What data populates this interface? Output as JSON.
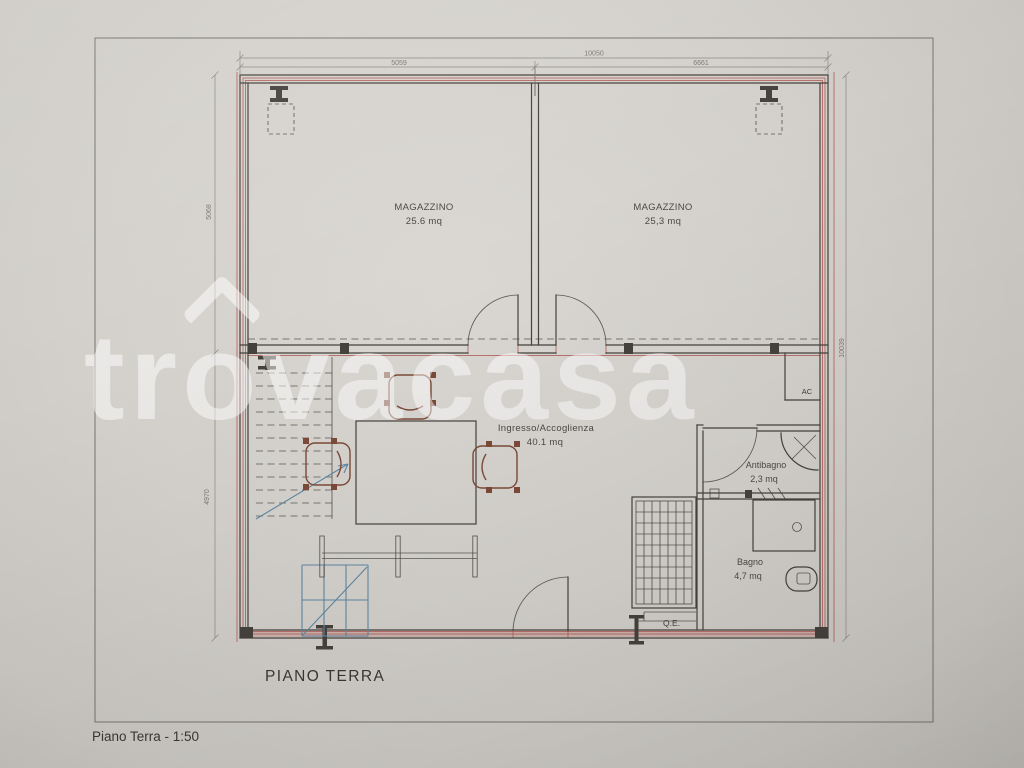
{
  "watermark": {
    "prefix": "tr",
    "o": "o",
    "suffix": "vacasa"
  },
  "rooms": {
    "magazzino_left": {
      "name": "MAGAZZINO",
      "area": "25.6 mq"
    },
    "magazzino_right": {
      "name": "MAGAZZINO",
      "area": "25,3 mq"
    },
    "ingresso": {
      "name": "Ingresso/Accoglienza",
      "area": "40.1 mq"
    },
    "antibagno": {
      "name": "Antibagno",
      "area": "2,3 mq"
    },
    "bagno": {
      "name": "Bagno",
      "area": "4,7 mq"
    }
  },
  "labels": {
    "ac": "AC",
    "qe": "Q.E."
  },
  "dimensions": {
    "top_total": "10050",
    "top_left": "5059",
    "top_right": "6661",
    "left_upper": "5068",
    "left_lower": "4970",
    "right_total": "10039"
  },
  "title": "PIANO TERRA",
  "footer": "Piano Terra - 1:50",
  "colors": {
    "wall_red": "#b45f5c",
    "stairs_blue": "#5e87a2",
    "chair_brown": "#7c4a38",
    "ink": "#45423d",
    "watermark_white": "rgba(255,255,255,0.5)"
  }
}
